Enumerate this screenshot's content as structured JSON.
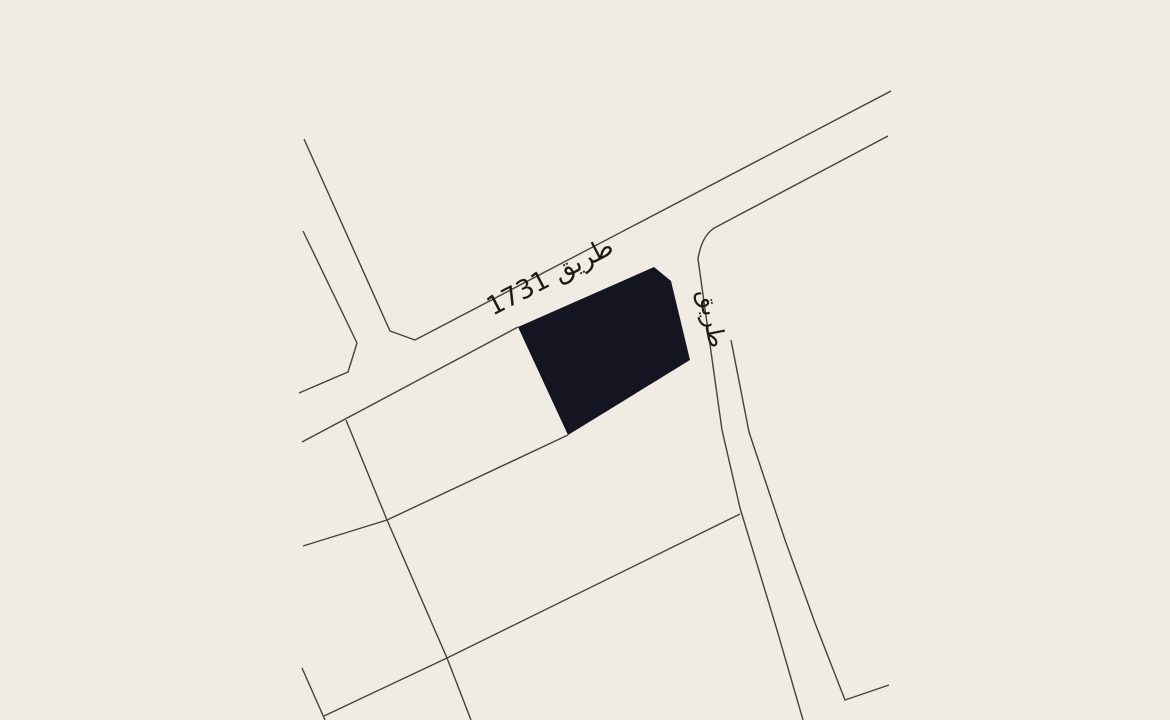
{
  "map": {
    "colors": {
      "background": "#f0ebe3",
      "road_line": "#474239",
      "parcel_fill": "#141520",
      "label": "#1c1a15"
    },
    "labels": {
      "main_road": {
        "text": "طريق 1731",
        "transform": "translate(554,284) rotate(-27.5)",
        "font_size": "26"
      },
      "side_road": {
        "text": "طريق",
        "transform": "translate(704,320) rotate(78.5)",
        "font_size": "24"
      }
    },
    "parcel": {
      "d": "M518,327 L654,267 L671,281 L690,360 L568,435 Z"
    },
    "roads": [
      {
        "name": "branch-road-left-edge",
        "d": "M303,231 L357,343 L348,372 L299,393"
      },
      {
        "name": "branch-road-right-edge-and-main-road-upper-edge",
        "d": "M304,139 L390,331 L415,340 L891,91"
      },
      {
        "name": "main-road-lower-edge-west",
        "d": "M302,442 L518,327"
      },
      {
        "name": "main-road-lower-edge-east-and-side-road-left-edge",
        "d": "M888,136 L718,226 Q702,233 698,259 L722,430 L740,508 L777,630 L803,720"
      },
      {
        "name": "side-road-right-edge",
        "d": "M731,340 L749,432 L785,540 L815,623 L845,700 L889,685"
      },
      {
        "name": "parcel-boundary-parallel-1",
        "d": "M303,546 L387,520 L568,435"
      },
      {
        "name": "parcel-boundary-parallel-2",
        "d": "M324,716 L447,658 L740,514"
      },
      {
        "name": "parcel-boundary-perpendicular",
        "d": "M346,420 L387,520 L447,658 L471,720"
      },
      {
        "name": "parcel-boundary-stub",
        "d": "M302,668 L325,720"
      }
    ]
  }
}
